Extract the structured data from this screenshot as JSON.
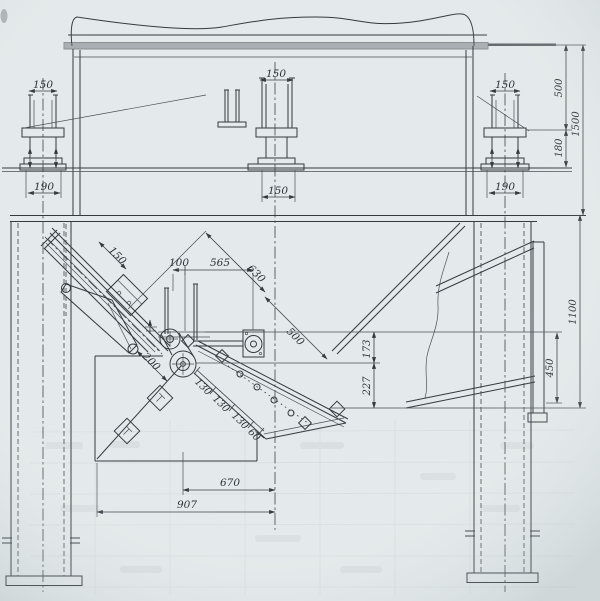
{
  "drawing": {
    "colors": {
      "paper": "#e4eaeb",
      "ink": "#343a3e",
      "flange_band": "#6d7478"
    },
    "dims": {
      "left_support_top": "150",
      "left_support_base": "190",
      "center_support_top": "150",
      "center_support_base": "150",
      "right_support_top": "150",
      "right_support_base": "190",
      "bracket_height": "500",
      "bracket_to_rail": "180",
      "top_to_frame": "1500",
      "frame_to_discharge": "1100",
      "side_plate_height": "450",
      "post_gap": "100",
      "deck_to_bearing": "565",
      "incline_upper": "630",
      "incline_lower": "500",
      "feed_chute_width": "150",
      "drive_offset": "200",
      "throat_upper": "173",
      "throat_lower": "227",
      "grizzly_pitch_a": "130",
      "grizzly_pitch_b": "130",
      "grizzly_pitch_c": "130",
      "grizzly_pitch_end": "60",
      "discharge_to_center": "670",
      "bin_to_center": "907"
    }
  }
}
